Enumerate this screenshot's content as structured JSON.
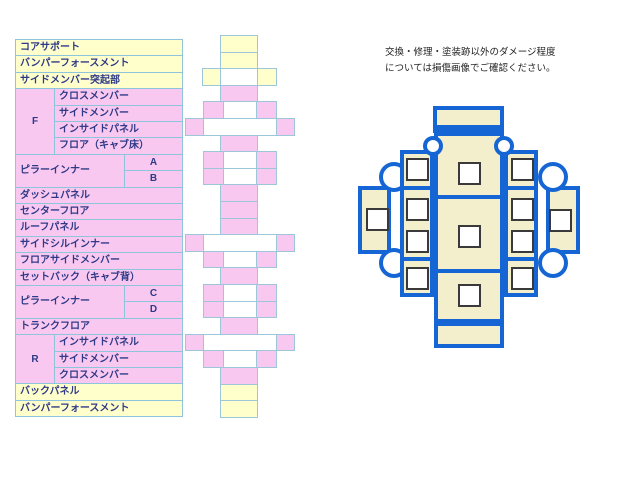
{
  "note": {
    "line1": "交換・修理・塗装跡以外のダメージ程度",
    "line2": "については損傷画像でご確認ください。"
  },
  "parts_table": {
    "colors": {
      "yellow": "#ffffcc",
      "pink": "#f9c8f0",
      "border": "#8ec4dc",
      "text": "#2e3a87"
    },
    "geometry": {
      "x": 15,
      "y": 39,
      "w": 167,
      "row_h": 16.4,
      "label_col_w": 39,
      "pillar_label_w": 109
    },
    "rows": [
      {
        "kind": "full",
        "bg": "yellow",
        "label": "コアサポート"
      },
      {
        "kind": "full",
        "bg": "yellow",
        "label": "バンパーフォースメント"
      },
      {
        "kind": "full",
        "bg": "yellow",
        "label": "サイドメンバー突起部"
      },
      {
        "kind": "sub",
        "bg": "pink",
        "label": "クロスメンバー"
      },
      {
        "kind": "sub",
        "bg": "pink",
        "label": "サイドメンバー"
      },
      {
        "kind": "sub",
        "bg": "pink",
        "label": "インサイドパネル"
      },
      {
        "kind": "sub",
        "bg": "pink",
        "label": "フロア（キャブ床）"
      },
      {
        "kind": "pillar",
        "bg": "pink",
        "sub": "A"
      },
      {
        "kind": "pillar",
        "bg": "pink",
        "sub": "B"
      },
      {
        "kind": "full",
        "bg": "pink",
        "label": "ダッシュパネル"
      },
      {
        "kind": "full",
        "bg": "pink",
        "label": "センターフロア"
      },
      {
        "kind": "full",
        "bg": "pink",
        "label": "ルーフパネル"
      },
      {
        "kind": "full",
        "bg": "pink",
        "label": "サイドシルインナー"
      },
      {
        "kind": "full",
        "bg": "pink",
        "label": "フロアサイドメンバー"
      },
      {
        "kind": "full",
        "bg": "pink",
        "label": "セットバック（キャブ背）"
      },
      {
        "kind": "pillar",
        "bg": "pink",
        "sub": "C"
      },
      {
        "kind": "pillar",
        "bg": "pink",
        "sub": "D"
      },
      {
        "kind": "full",
        "bg": "pink",
        "label": "トランクフロア"
      },
      {
        "kind": "sub",
        "bg": "pink",
        "label": "インサイドパネル"
      },
      {
        "kind": "sub",
        "bg": "pink",
        "label": "サイドメンバー"
      },
      {
        "kind": "sub",
        "bg": "pink",
        "label": "クロスメンバー"
      },
      {
        "kind": "full",
        "bg": "yellow",
        "label": "バックパネル"
      },
      {
        "kind": "full",
        "bg": "yellow",
        "label": "バンパーフォースメント"
      }
    ],
    "span_labels": [
      {
        "text": "F",
        "row_start": 3,
        "row_span": 4,
        "w": 39,
        "align": "center"
      },
      {
        "text": "ピラーインナー",
        "row_start": 7,
        "row_span": 2,
        "w": 109,
        "align": "left"
      },
      {
        "text": "ピラーインナー",
        "row_start": 15,
        "row_span": 2,
        "w": 109,
        "align": "left"
      },
      {
        "text": "R",
        "row_start": 18,
        "row_span": 3,
        "w": 39,
        "align": "center"
      }
    ]
  },
  "skeleton": {
    "colors": {
      "yellow": "#ffffcc",
      "pink": "#f9c8f0",
      "white": "#ffffff",
      "border": "#9cc6da"
    },
    "top": 35,
    "row_h": 16.6,
    "bands": [
      {
        "cells": [
          {
            "x": 220,
            "w": 37,
            "c": "yellow"
          }
        ]
      },
      {
        "cells": [
          {
            "x": 220,
            "w": 37,
            "c": "yellow"
          }
        ]
      },
      {
        "cells": [
          {
            "x": 202,
            "w": 18,
            "c": "yellow"
          },
          {
            "x": 220,
            "w": 37,
            "c": "white"
          },
          {
            "x": 257,
            "w": 19,
            "c": "yellow"
          }
        ]
      },
      {
        "cells": [
          {
            "x": 220,
            "w": 37,
            "c": "pink"
          }
        ]
      },
      {
        "cells": [
          {
            "x": 203,
            "w": 20,
            "c": "pink"
          },
          {
            "x": 223,
            "w": 33,
            "c": "white"
          },
          {
            "x": 256,
            "w": 20,
            "c": "pink"
          }
        ]
      },
      {
        "cells": [
          {
            "x": 185,
            "w": 18,
            "c": "pink"
          },
          {
            "x": 203,
            "w": 73,
            "c": "white"
          },
          {
            "x": 276,
            "w": 18,
            "c": "pink"
          }
        ]
      },
      {
        "cells": [
          {
            "x": 220,
            "w": 37,
            "c": "pink"
          }
        ]
      },
      {
        "cells": [
          {
            "x": 203,
            "w": 20,
            "c": "pink"
          },
          {
            "x": 223,
            "w": 33,
            "c": "white"
          },
          {
            "x": 256,
            "w": 20,
            "c": "pink"
          }
        ]
      },
      {
        "cells": [
          {
            "x": 203,
            "w": 20,
            "c": "pink"
          },
          {
            "x": 223,
            "w": 33,
            "c": "white"
          },
          {
            "x": 256,
            "w": 20,
            "c": "pink"
          }
        ]
      },
      {
        "cells": [
          {
            "x": 220,
            "w": 37,
            "c": "pink"
          }
        ]
      },
      {
        "cells": [
          {
            "x": 220,
            "w": 37,
            "c": "pink"
          }
        ]
      },
      {
        "cells": [
          {
            "x": 220,
            "w": 37,
            "c": "pink"
          }
        ]
      },
      {
        "cells": [
          {
            "x": 185,
            "w": 18,
            "c": "pink"
          },
          {
            "x": 203,
            "w": 73,
            "c": "white"
          },
          {
            "x": 276,
            "w": 18,
            "c": "pink"
          }
        ]
      },
      {
        "cells": [
          {
            "x": 203,
            "w": 20,
            "c": "pink"
          },
          {
            "x": 223,
            "w": 33,
            "c": "white"
          },
          {
            "x": 256,
            "w": 20,
            "c": "pink"
          }
        ]
      },
      {
        "cells": [
          {
            "x": 220,
            "w": 37,
            "c": "pink"
          }
        ]
      },
      {
        "cells": [
          {
            "x": 203,
            "w": 20,
            "c": "pink"
          },
          {
            "x": 223,
            "w": 33,
            "c": "white"
          },
          {
            "x": 256,
            "w": 20,
            "c": "pink"
          }
        ]
      },
      {
        "cells": [
          {
            "x": 203,
            "w": 20,
            "c": "pink"
          },
          {
            "x": 223,
            "w": 33,
            "c": "white"
          },
          {
            "x": 256,
            "w": 20,
            "c": "pink"
          }
        ]
      },
      {
        "cells": [
          {
            "x": 220,
            "w": 37,
            "c": "pink"
          }
        ]
      },
      {
        "cells": [
          {
            "x": 185,
            "w": 18,
            "c": "pink"
          },
          {
            "x": 203,
            "w": 73,
            "c": "white"
          },
          {
            "x": 276,
            "w": 18,
            "c": "pink"
          }
        ]
      },
      {
        "cells": [
          {
            "x": 203,
            "w": 20,
            "c": "pink"
          },
          {
            "x": 223,
            "w": 33,
            "c": "white"
          },
          {
            "x": 256,
            "w": 20,
            "c": "pink"
          }
        ]
      },
      {
        "cells": [
          {
            "x": 220,
            "w": 37,
            "c": "pink"
          }
        ]
      },
      {
        "cells": [
          {
            "x": 220,
            "w": 37,
            "c": "yellow"
          }
        ]
      },
      {
        "cells": [
          {
            "x": 220,
            "w": 37,
            "c": "yellow"
          }
        ]
      }
    ]
  },
  "underbody": {
    "colors": {
      "line": "#1566d4",
      "fill": "#f3eecb",
      "square_border": "#3a3a3a"
    },
    "rects": [
      {
        "name": "left-wing",
        "x": 358,
        "y": 186,
        "w": 33,
        "h": 68,
        "z": 1
      },
      {
        "name": "right-wing",
        "x": 546,
        "y": 186,
        "w": 34,
        "h": 68,
        "z": 1
      },
      {
        "name": "left-rocker",
        "x": 400,
        "y": 150,
        "w": 34,
        "h": 147,
        "z": 3
      },
      {
        "name": "right-rocker",
        "x": 504,
        "y": 150,
        "w": 34,
        "h": 147,
        "z": 3
      },
      {
        "name": "center-floor",
        "x": 434,
        "y": 132,
        "w": 70,
        "h": 191,
        "z": 4
      },
      {
        "name": "front-bumper",
        "x": 433,
        "y": 106,
        "w": 71,
        "h": 27,
        "z": 4
      },
      {
        "name": "rear-bumper",
        "x": 434,
        "y": 322,
        "w": 70,
        "h": 26,
        "z": 4
      }
    ],
    "big_circle_r": 15,
    "big_circles": [
      {
        "cx": 394,
        "cy": 177
      },
      {
        "cx": 394,
        "cy": 263
      },
      {
        "cx": 553,
        "cy": 177
      },
      {
        "cx": 553,
        "cy": 263
      }
    ],
    "small_circle_r": 10,
    "small_circles": [
      {
        "cx": 433,
        "cy": 146
      },
      {
        "cx": 504,
        "cy": 146
      }
    ],
    "dividers": [
      {
        "x": 433,
        "y": 125,
        "w": 71
      },
      {
        "x": 434,
        "y": 195,
        "w": 70
      },
      {
        "x": 434,
        "y": 269,
        "w": 70
      },
      {
        "x": 400,
        "y": 186,
        "w": 34
      },
      {
        "x": 400,
        "y": 257,
        "w": 34
      },
      {
        "x": 504,
        "y": 186,
        "w": 34
      },
      {
        "x": 504,
        "y": 257,
        "w": 34
      }
    ],
    "squares": [
      {
        "x": 366,
        "y": 208
      },
      {
        "x": 549,
        "y": 209
      },
      {
        "x": 406,
        "y": 158
      },
      {
        "x": 406,
        "y": 198
      },
      {
        "x": 406,
        "y": 230
      },
      {
        "x": 406,
        "y": 267
      },
      {
        "x": 511,
        "y": 158
      },
      {
        "x": 511,
        "y": 198
      },
      {
        "x": 511,
        "y": 230
      },
      {
        "x": 511,
        "y": 267
      },
      {
        "x": 458,
        "y": 162
      },
      {
        "x": 458,
        "y": 225
      },
      {
        "x": 458,
        "y": 284
      }
    ]
  }
}
